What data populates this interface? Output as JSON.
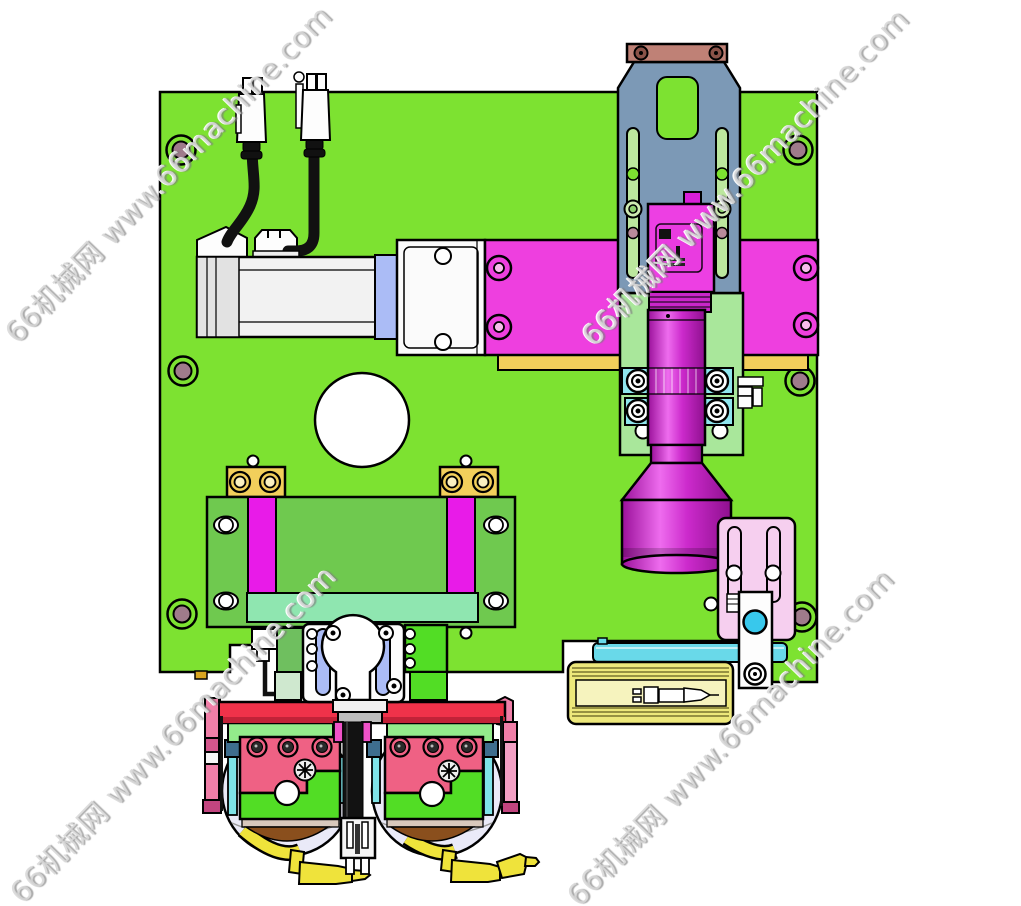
{
  "watermark": {
    "text": "66机械网 www.66machine.com",
    "color": "#d7d7d7",
    "instances": 4
  },
  "colors": {
    "base_plate": "#7DE231",
    "stage_plate": "#6FC94F",
    "mint_bar": "#8FE6B0",
    "magenta_rail": "#E81BE8",
    "magenta_block": "#EE3FDF",
    "camera_body": "#ED3FE3",
    "steel_blue_bracket": "#7C99B6",
    "brown_mount_bar": "#BF8176",
    "yellow_block": "#F2CF5B",
    "laser_block_yellow": "#EDE87B",
    "cyan_clamp": "#8FE5ED",
    "shaft_cyan": "#69D9E9",
    "periwinkle_rail": "#ABBCF6",
    "lavender_bowl": "#EAEAF8",
    "red_bar": "#F0324A",
    "rose_plate": "#EF6184",
    "pink_bar": "#F07FA8",
    "pale_pink_bracket": "#F6CFEF",
    "bright_green_plate": "#52DD25",
    "light_green_bar": "#93EB8B",
    "teal_spacer": "#3E6E8E",
    "brown_lens": "#8A4F1D",
    "nozzle_yellow": "#EFE33B",
    "lens_clamp_plate": "#A9E79B",
    "sensor_dot_cyan": "#38C8EC",
    "hole_inner": "#9F7B8B",
    "gold": "#D9A520"
  }
}
